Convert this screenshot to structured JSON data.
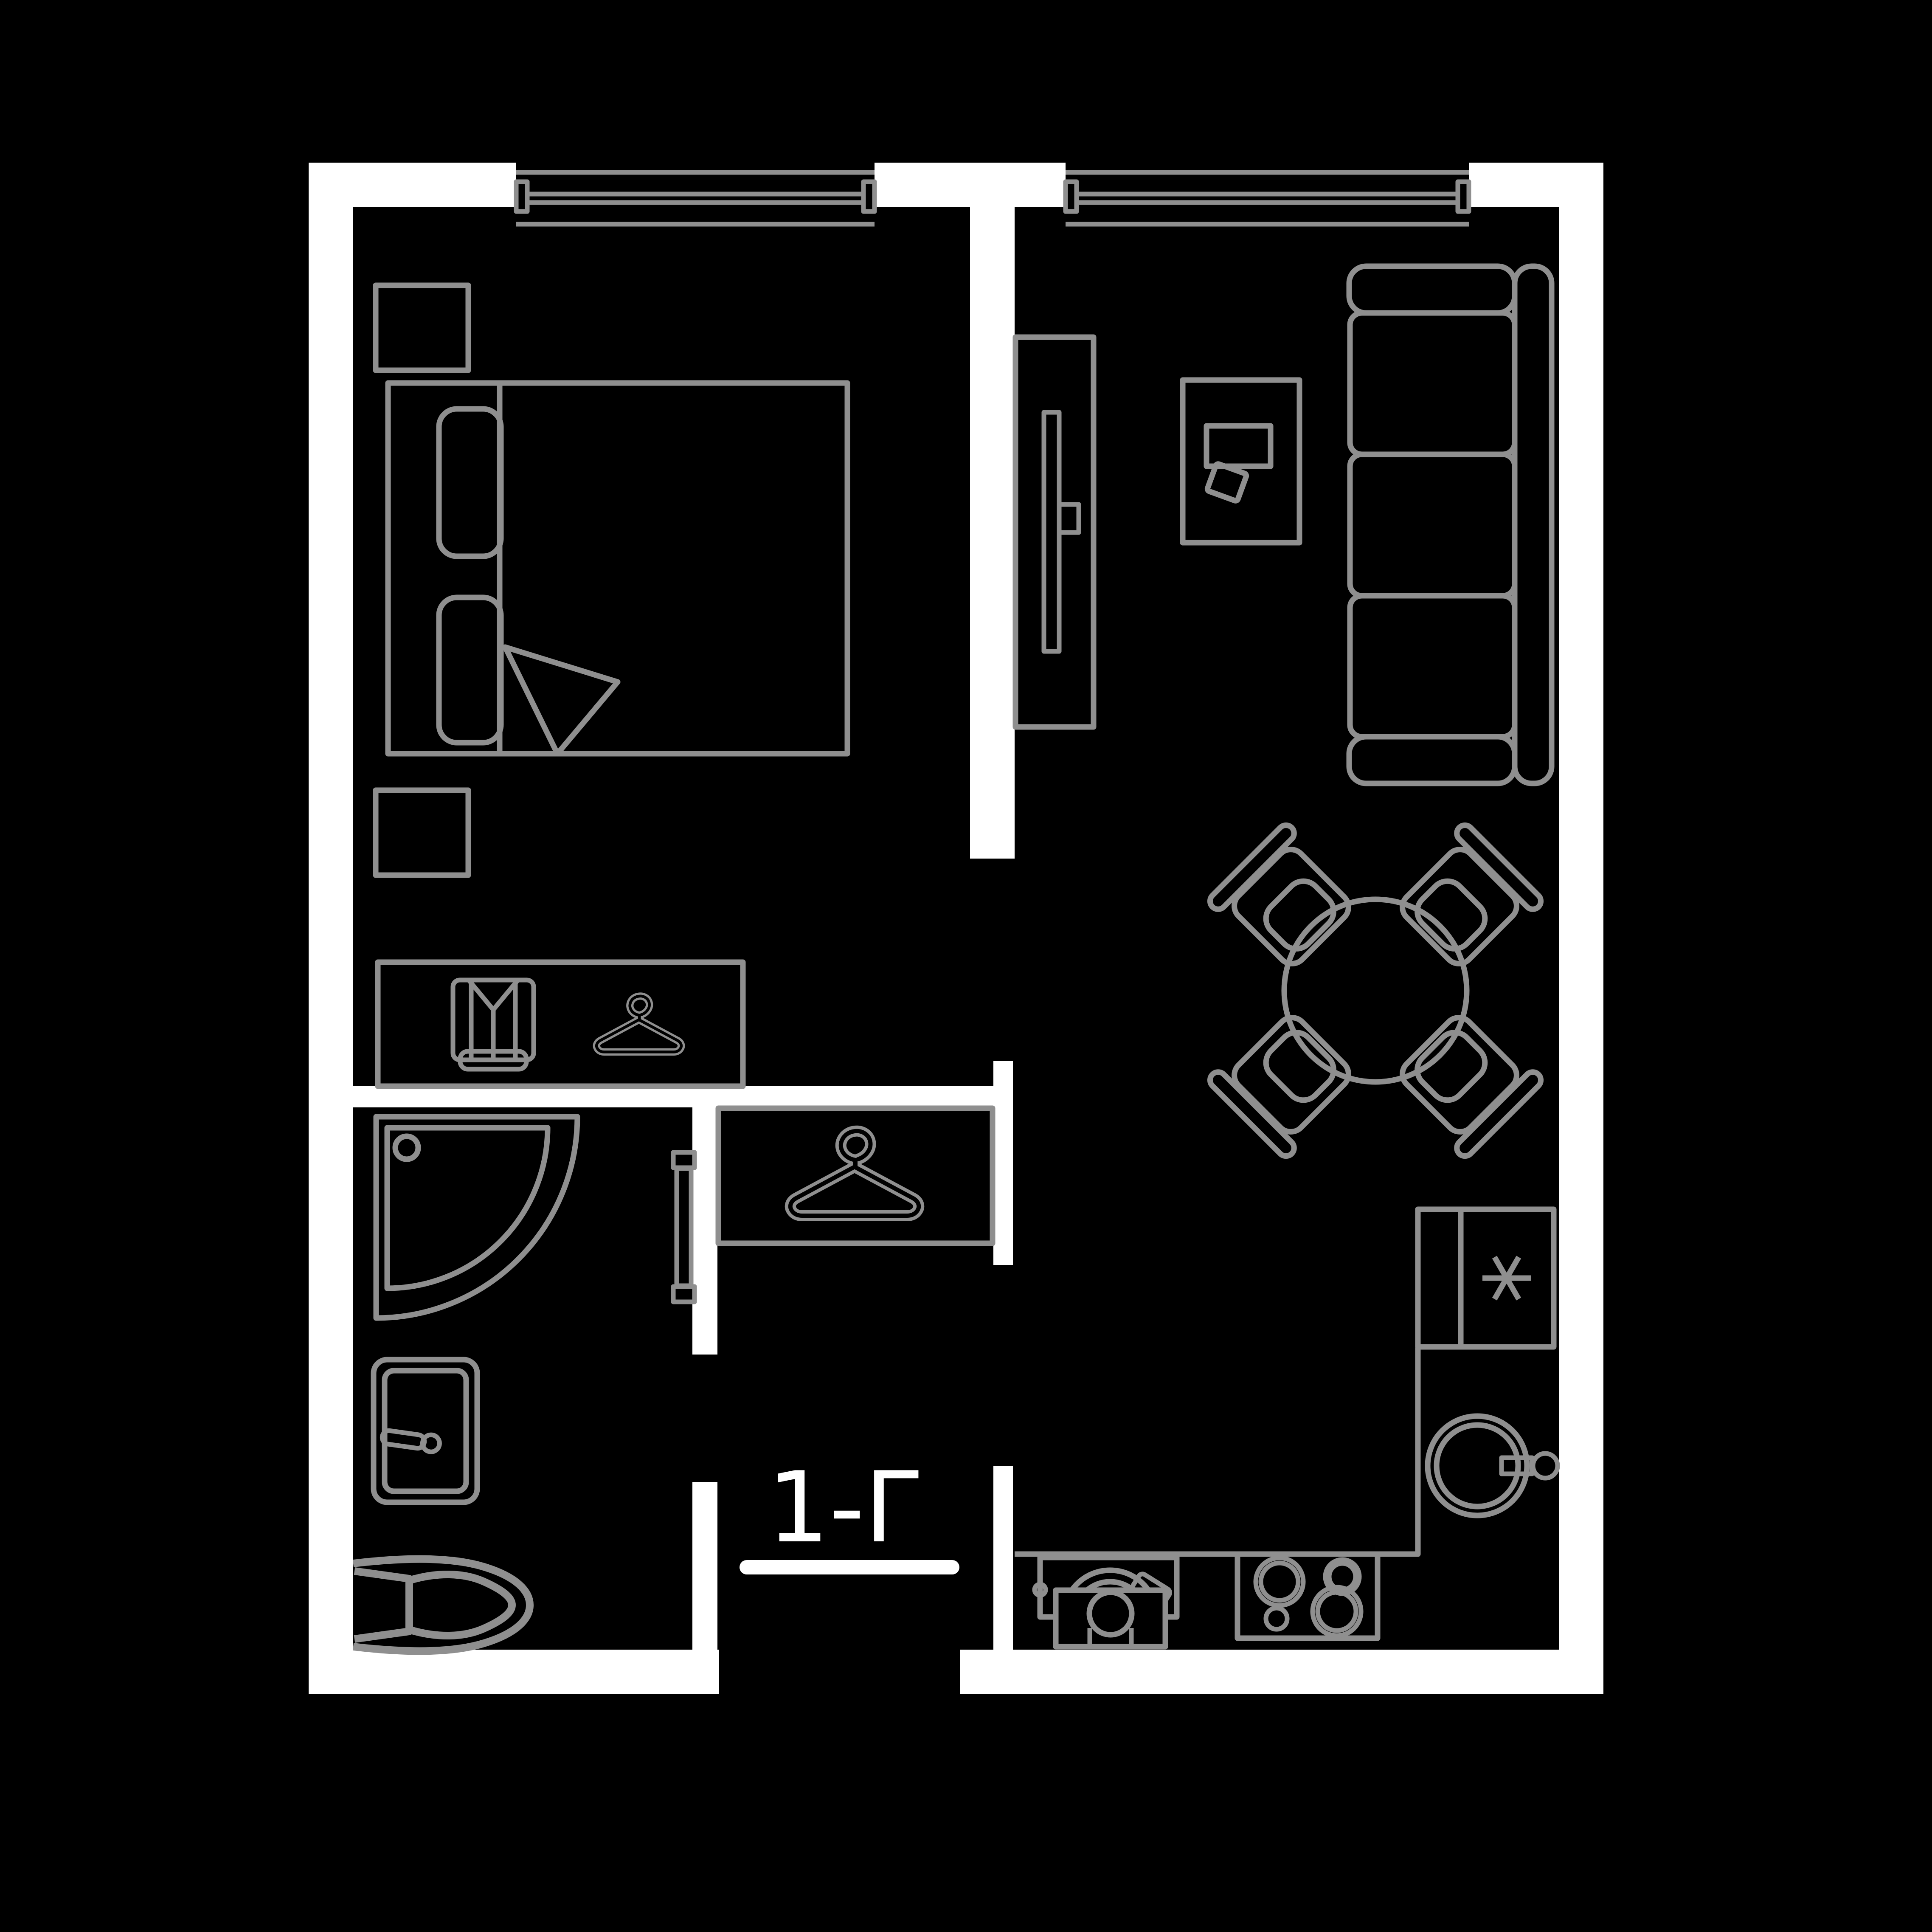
{
  "plan": {
    "label": "1-Г"
  },
  "colors": {
    "background": "#000000",
    "walls": "#ffffff",
    "outline": "#8f8f8f",
    "label_text": "#ffffff"
  },
  "icons": {
    "wardrobe": [
      "folded-shirt-icon",
      "clothes-hanger-icon"
    ],
    "hall_closet": [
      "clothes-hanger-icon"
    ],
    "fridge": [
      "asterisk-freezer-icon"
    ]
  }
}
